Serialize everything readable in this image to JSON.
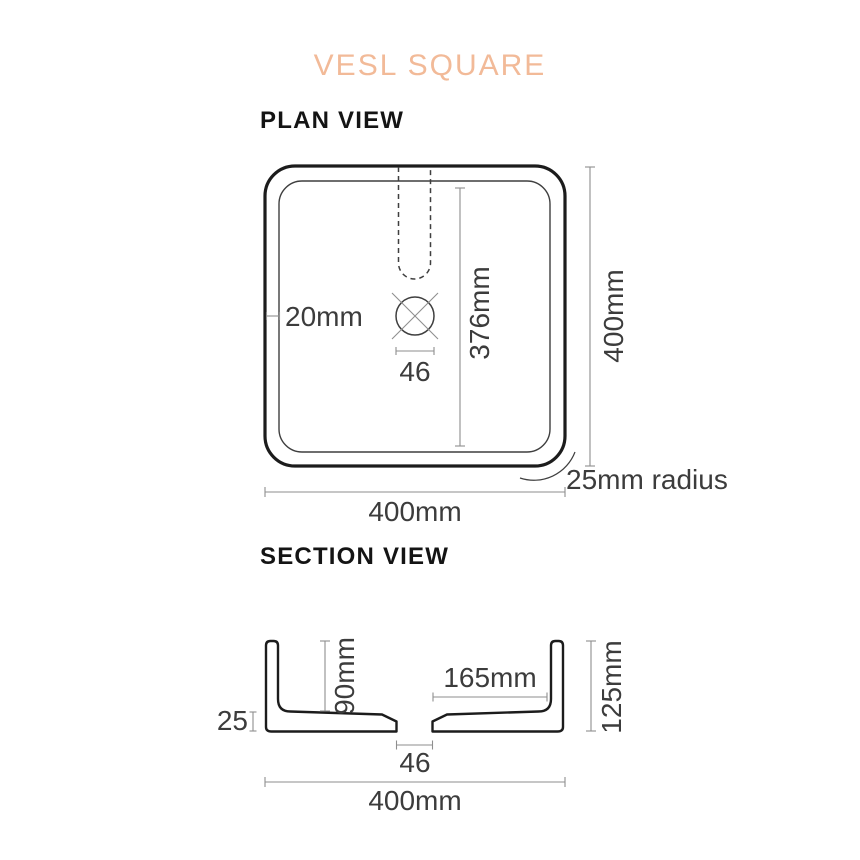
{
  "title": "VESL SQUARE",
  "colors": {
    "accent_peach": "#F2BA98",
    "line_dark": "#1C1C1C",
    "line_gray": "#8E8E8E",
    "dim_text": "#3C3C3C"
  },
  "plan_view": {
    "heading": "PLAN VIEW",
    "labels": {
      "wall_thickness": "20mm",
      "inner_length": "376mm",
      "drain_width": "46",
      "overall_height": "400mm",
      "corner_radius": "25mm radius",
      "overall_width": "400mm"
    }
  },
  "section_view": {
    "heading": "SECTION VIEW",
    "labels": {
      "base_thickness": "25",
      "inner_depth": "90mm",
      "base_inner_width": "165mm",
      "overall_height": "125mm",
      "drain_width": "46",
      "overall_width": "400mm"
    }
  }
}
